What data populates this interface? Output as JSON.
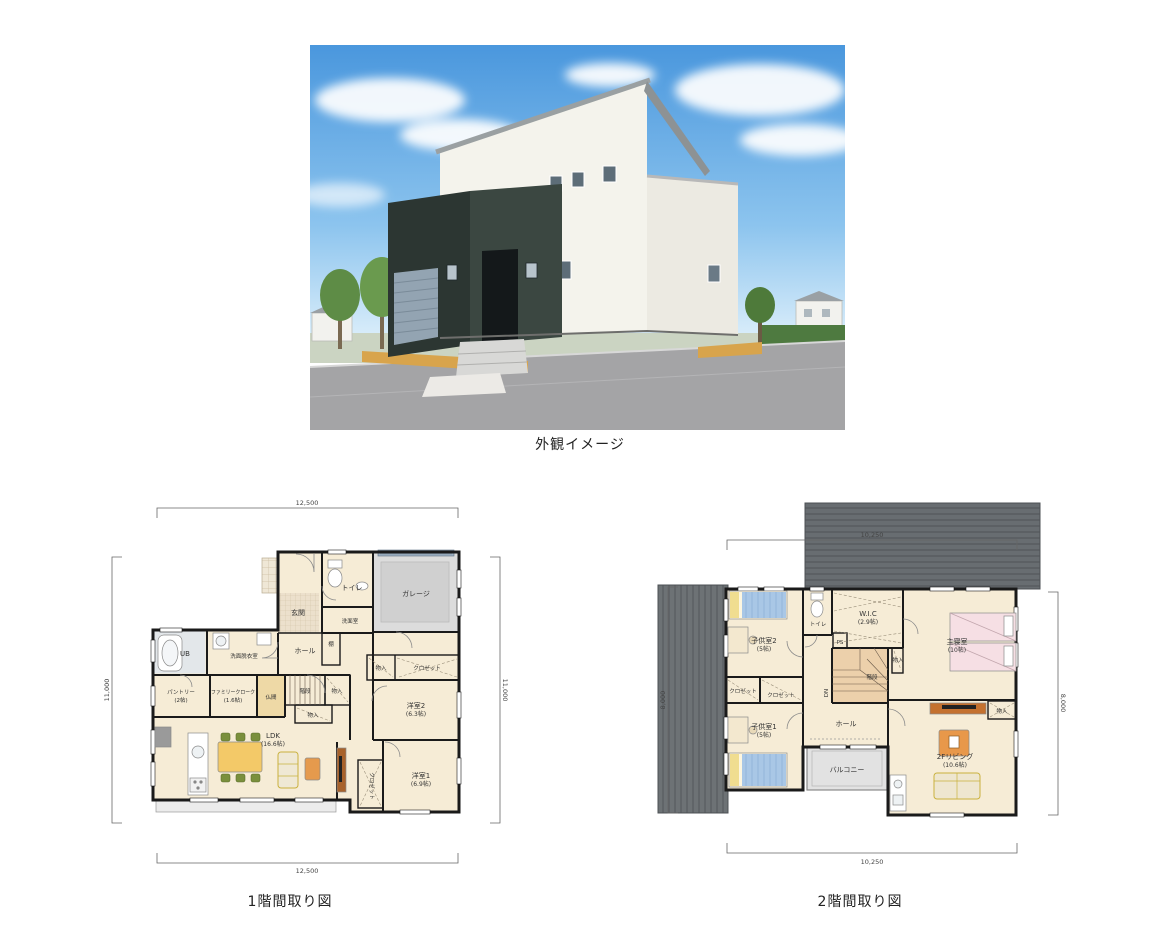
{
  "exterior": {
    "caption": "外観イメージ",
    "colors": {
      "sky": "#4a97dd",
      "wall_white": "#f4f3ec",
      "wall_dark": "#3b4741",
      "road": "#a4a4a6",
      "gravel": "#d8a44c",
      "hedge": "#4e7a40"
    }
  },
  "floor1": {
    "caption": "1階間取り図",
    "dims": {
      "top": "12,500",
      "bottom": "12,500",
      "left": "11,000",
      "right": "11,000"
    },
    "rooms": {
      "genkan": "玄関",
      "toilet": "トイレ",
      "washroom": "洗面室",
      "shelf": "棚",
      "garage": "ガレージ",
      "hall": "ホール",
      "ub": "UB",
      "dressing": "洗面脱衣室",
      "pantry": "パントリー",
      "pantry_size": "(2帖)",
      "family_closet": "ファミリークローク",
      "family_closet_size": "(1.6帖)",
      "butsuma": "仏間",
      "stairs": "階段",
      "storage_a": "物入",
      "storage_b": "物入",
      "storage_c": "物入",
      "closet_a": "クロゼット",
      "closet_b": "クロゼット",
      "room2": "洋室2",
      "room2_size": "(6.3帖)",
      "room1": "洋室1",
      "room1_size": "(6.9帖)",
      "ldk": "LDK",
      "ldk_size": "(16.6帖)"
    },
    "colors": {
      "floor": "#f6ecd6",
      "garage": "#dcdcdc",
      "deck": "#ececec",
      "butsuma": "#eed9a6",
      "bath": "#e3e7ea"
    }
  },
  "floor2": {
    "caption": "2階間取り図",
    "dims": {
      "top": "10,250",
      "bottom": "10,250",
      "left": "8,000",
      "right": "8,000"
    },
    "rooms": {
      "kids2": "子供室2",
      "kids2_size": "(5帖)",
      "toilet": "トイレ",
      "wic": "W.I.C",
      "wic_size": "(2.9帖)",
      "ps": "PS",
      "master": "主寝室",
      "master_size": "(10帖)",
      "storage_a": "物入",
      "storage_b": "物入",
      "closet_a": "クロゼット",
      "closet_b": "クロゼット",
      "stairs": "階段",
      "dn": "DN",
      "hall": "ホール",
      "kids1": "子供室1",
      "kids1_size": "(5帖)",
      "balcony": "バルコニー",
      "living": "2Fリビング",
      "living_size": "(10.6帖)"
    },
    "colors": {
      "roof": "#686d71",
      "floor": "#f6ecd6",
      "balcony": "#e2e2e2",
      "stairs": "#ecd0ab",
      "bed_blue": "#a9c7e6",
      "bed_pink": "#f6dfe4"
    }
  }
}
